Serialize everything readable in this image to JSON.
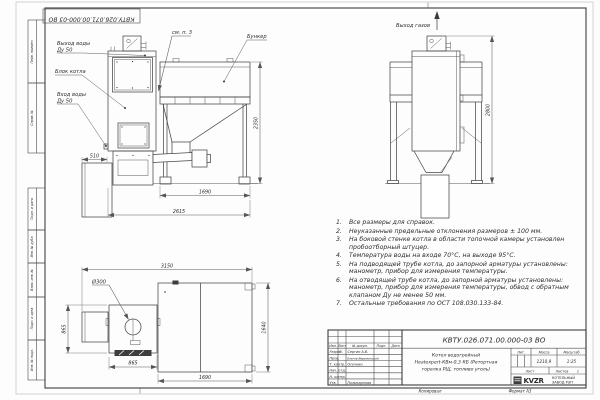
{
  "frame": {
    "stamp": "КВТУ.026.071.00.000-03 ВО",
    "side_labels": [
      "Перв. примен.",
      "Справ. №",
      "Подп. и дата",
      "Инв. № дубл.",
      "Взам. инв. №",
      "Подп. и дата",
      "Инв. № подл."
    ],
    "footer_copied": "Копировал",
    "footer_format": "Формат А3"
  },
  "front_view": {
    "water_outlet_l1": "Выход воды",
    "water_outlet_l2": "Ду 50",
    "boiler_block": "Блок котла",
    "water_inlet_l1": "Вход воды",
    "water_inlet_l2": "Ду 50",
    "see_note": "см. п. 3",
    "bunker": "Бункер",
    "dim_ash_box": "510",
    "dim_height": "2350",
    "dim_bunker_len": "1690",
    "dim_overall_len": "2615"
  },
  "side_view": {
    "gas_outlet": "Выход газов",
    "dim_height": "2800"
  },
  "plan_view": {
    "flue_dia": "Ø300",
    "dim_overall": "3150",
    "dim_boiler_w": "865",
    "dim_boiler_l": "865",
    "dim_bunker_l": "1690",
    "dim_bunker_w": "1640"
  },
  "notes": {
    "items": [
      {
        "num": "1.",
        "text": "Все размеры для справок."
      },
      {
        "num": "2.",
        "text": "Неуказанные предельные отклонения размеров ± 100 мм."
      },
      {
        "num": "3.",
        "text": "На боковой стенке котла в области топочной камеры установлен пробоотборный штуцер."
      },
      {
        "num": "4.",
        "text": "Температура воды на входе 70°С, на выходе 95°С."
      },
      {
        "num": "5.",
        "text": "На подводящей трубе котла, до запорной арматуры установлены: манометр, прибор для измерения температуры."
      },
      {
        "num": "6.",
        "text": "На отводящей трубе котла, до запорной арматуры установлены: манометр, прибор для измерения температуры, обвод с обратным клапаном Ду не менее 50 мм."
      },
      {
        "num": "7.",
        "text": "Остальные требования по ОСТ 108.030.133-84."
      }
    ]
  },
  "title_block": {
    "doc_number": "КВТУ.026.071.00.000-03 ВО",
    "name_l1": "Котел водогрейный",
    "name_l2": "Heatexpert-КВм-0,3 КБ (Ретортная",
    "name_l3": "горелка РЩ, топливо уголь)",
    "col_izm": "Изм.",
    "col_list": "Лист",
    "col_doc": "№ докум.",
    "col_sign": "Подп.",
    "col_date": "Дата",
    "rows": [
      {
        "role": "Разраб.",
        "name": "Сергин А.В."
      },
      {
        "role": "Пров.",
        "name": "Онегов-Вережинский"
      },
      {
        "role": "Т. контр.",
        "name": "Осечкин"
      },
      {
        "role": "Нач. отд.",
        "name": ""
      },
      {
        "role": "Н. контр.",
        "name": ""
      },
      {
        "role": "Утв.",
        "name": "Поликарпова"
      }
    ],
    "lit_label": "Лит.",
    "mass_label": "Масса",
    "mass_value": "1210,9",
    "scale_label": "Масштаб",
    "scale_value": "1:25",
    "sheet_label": "Лист",
    "sheets_label": "Листов",
    "sheets_value": "1",
    "logo_text": "KVZR",
    "company_l1": "КОТЕЛЬНЫЙ",
    "company_l2": "ЗАВОД РЭП"
  },
  "colors": {
    "line": "#474747",
    "dim": "#5c5c5c",
    "text": "#2b2b2b",
    "paper": "#fdfdfd"
  }
}
